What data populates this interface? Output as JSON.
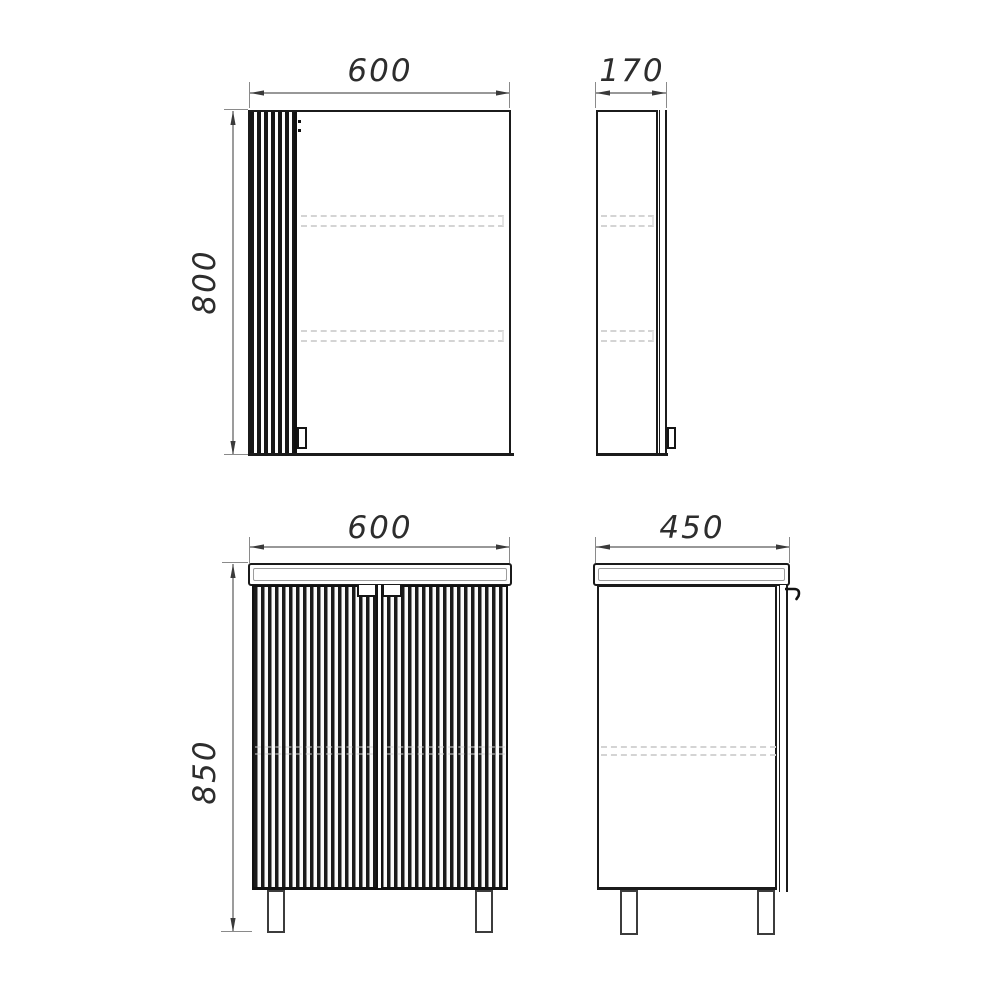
{
  "drawing": {
    "type": "furniture dimension drawing",
    "colors": {
      "outline": "#1b1b1b",
      "dimension_line": "#5a5a5a",
      "hidden_line": "#d4d4d4",
      "background": "#ffffff"
    },
    "views": {
      "mirror_cabinet_front": {
        "width_mm": "600",
        "height_mm": "800"
      },
      "mirror_cabinet_side": {
        "depth_mm": "170"
      },
      "base_cabinet_front": {
        "width_mm": "600",
        "height_mm": "850"
      },
      "base_cabinet_side": {
        "depth_mm": "450"
      }
    }
  }
}
